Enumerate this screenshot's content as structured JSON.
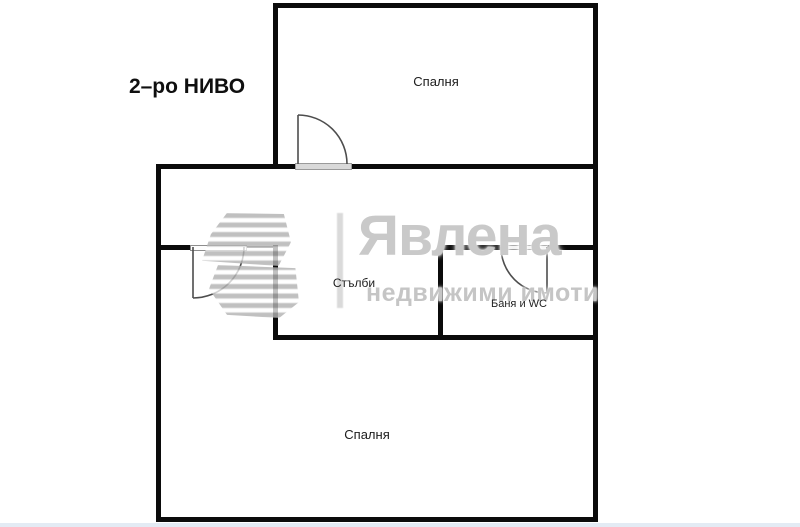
{
  "floorplan": {
    "level_label": "2–ро НИВО",
    "rooms": {
      "bedroom_top": "Спалня",
      "stairs": "Стълби",
      "bath_wc": "Баня и WC",
      "bedroom_bottom": "Спалня"
    },
    "colors": {
      "wall": "#0b0b0b",
      "door_line": "#4d4d4d",
      "watermark_grey": "#c9c9c9"
    }
  },
  "watermark": {
    "brand": "Явлена",
    "tagline": "недвижими имоти",
    "logo": "stairs-logo"
  }
}
